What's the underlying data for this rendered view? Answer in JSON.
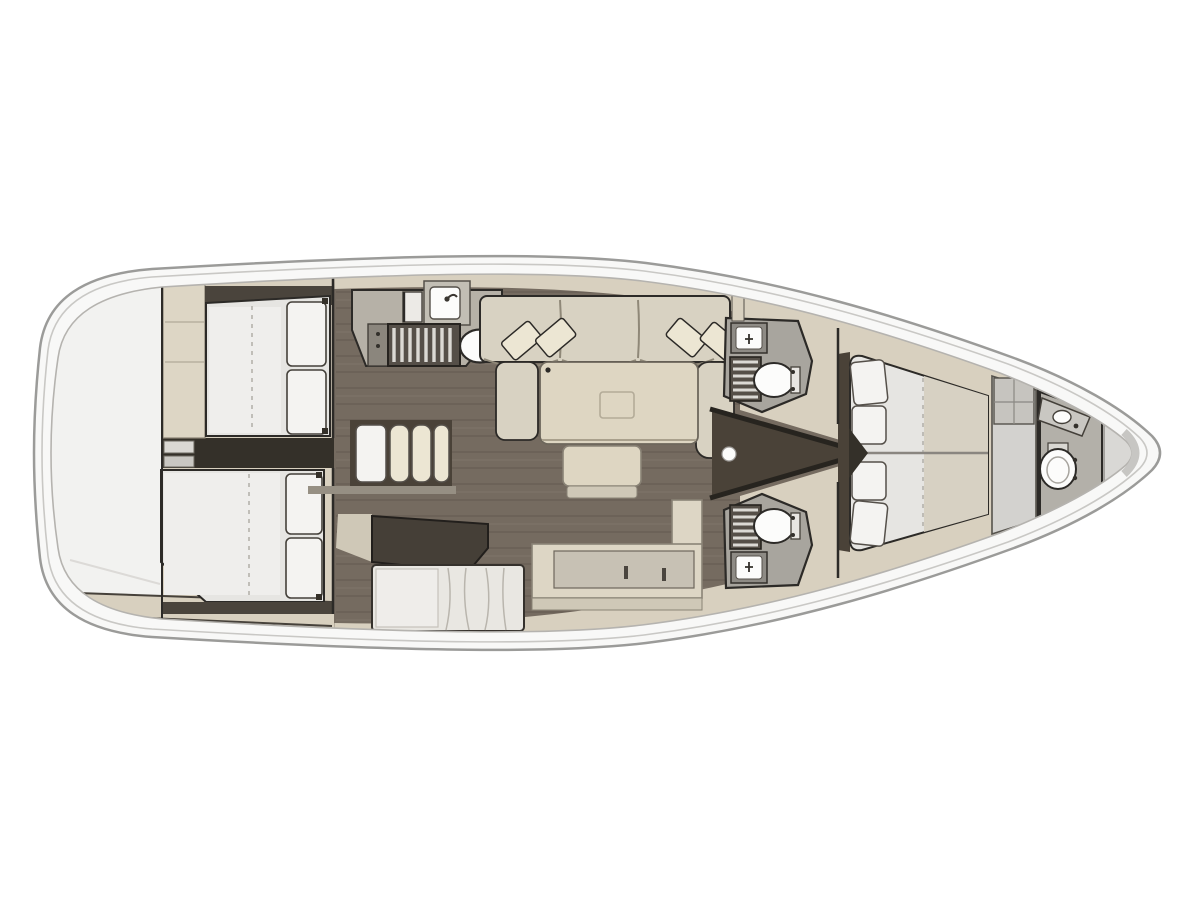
{
  "figure": {
    "kind": "sailing-yacht-interior-floor-plan",
    "orientation": "bow-right",
    "rooms": [
      "swim-platform",
      "aft-cabin-port",
      "aft-cabin-starboard",
      "companionway",
      "galley",
      "salon",
      "nav-station",
      "head-port",
      "head-starboard",
      "forward-cabin",
      "bow-head"
    ]
  },
  "colors": {
    "bg": "#ffffff",
    "hullFill": "#f8f8f7",
    "hullStroke": "#9b9b99",
    "sheer": "#c9c8c5",
    "base": "#d8d0bf",
    "cabinet": "#ddd6c5",
    "cabinetShade": "#cfc8b7",
    "counter": "#b6b1a7",
    "floor": "#756b60",
    "floorMid": "#4a4238",
    "floorDeep": "#343029",
    "darkBand": "#4a443c",
    "wall": "#2c2a27",
    "wallSoft": "#6d675c",
    "mattress": "#e6e5e2",
    "mattressLight": "#efeeec",
    "pillow": "#f4f3f1",
    "sofa": "#d8d2c2",
    "cushion": "#ece6d3",
    "table": "#ded6c2",
    "grate": "#554f48",
    "grateBar": "#dbd9d4",
    "white": "#fcfcfb",
    "headFloor": "#a8a59e",
    "wardrobe": "#d3d2cf",
    "marble": "#e9e7e2",
    "platform": "#f2f2f0"
  }
}
